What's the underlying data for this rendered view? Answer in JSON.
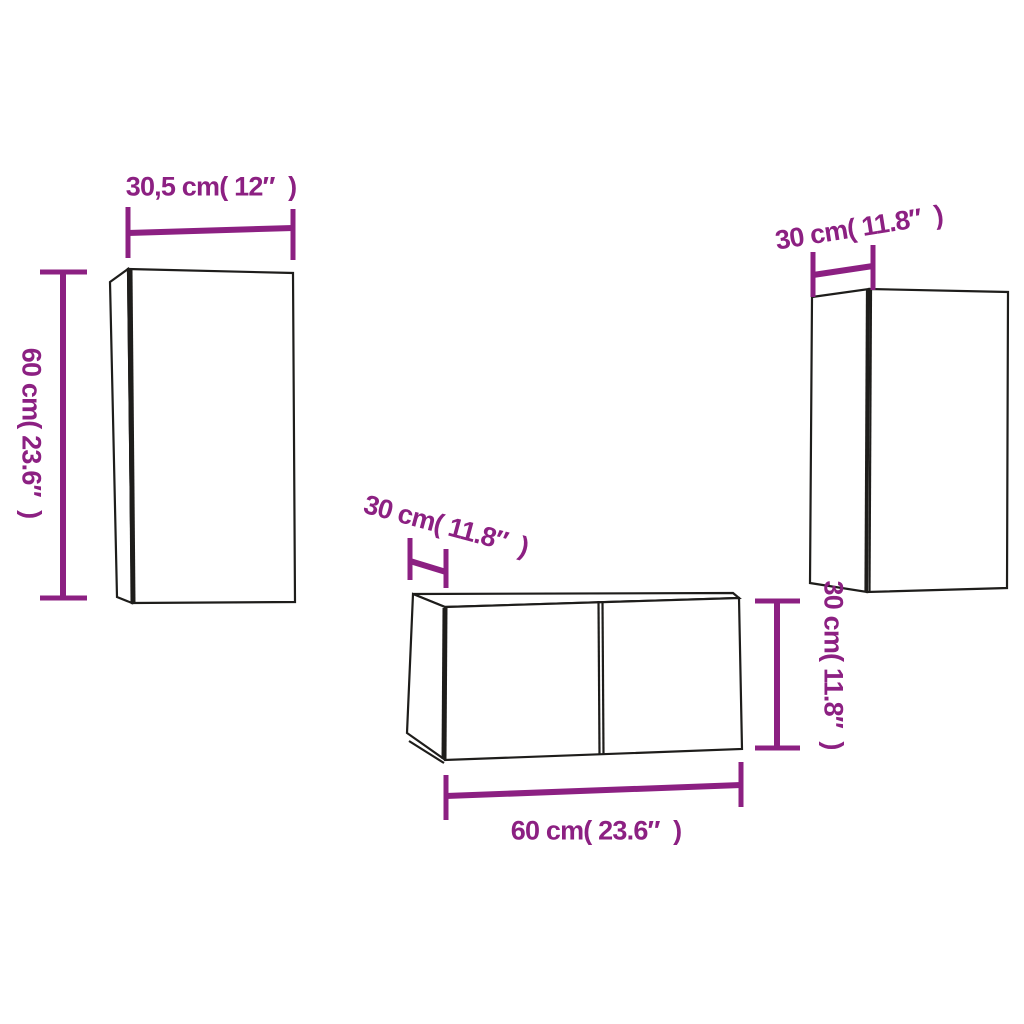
{
  "colors": {
    "accent": "#8C2082",
    "outline": "#1E1D1B",
    "background": "#FFFFFF"
  },
  "diagram_type": "furniture-dimension-diagram",
  "cabinets": {
    "left": {
      "top_label": "30,5 cm( 12″  )",
      "side_label": "60 cm( 23.6″  )"
    },
    "right": {
      "top_label": "30 cm( 11.8″  )"
    },
    "bench": {
      "depth_label": "30 cm( 11.8″  )",
      "width_label": "60 cm( 23.6″  )",
      "height_label": "30 cm( 11.8″  )"
    }
  }
}
